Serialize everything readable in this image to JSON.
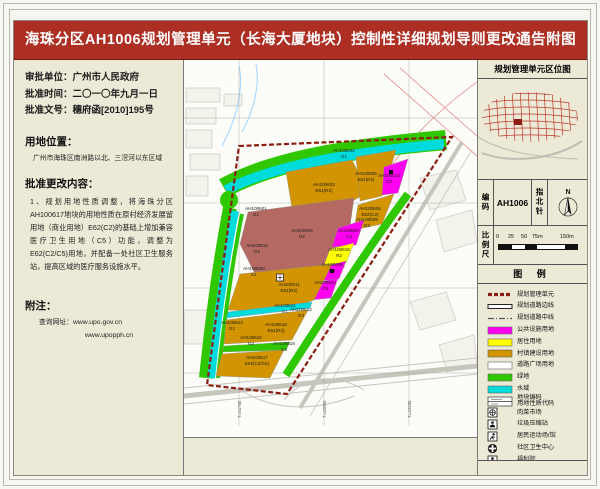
{
  "title": "海珠分区AH1006规划管理单元（长海大厦地块）控制性详细规划导则更改通告附图",
  "colors": {
    "title_bg": "#ad2f24",
    "panel_bg": "#ece9d6",
    "boundary_red": "#8b1d12",
    "public_facility": "#ff00f0",
    "residential": "#ffff00",
    "village_construction": "#d29400",
    "road_square": "#ffffff",
    "green_space": "#2fc800",
    "water": "#00dcdc",
    "existing_residential": "#b46a62"
  },
  "left_panel": {
    "info_lines": [
      {
        "label": "审批单位：",
        "value": "广州市人民政府"
      },
      {
        "label": "批准时间：",
        "value": "二〇一〇年九月一日"
      },
      {
        "label": "批准文号：",
        "value": "穗府函[2010]195号"
      }
    ],
    "location_header": "用地位置：",
    "location_text": "广州市海珠区南洲路以北、三滘河以东区域",
    "changes_header": "批准更改内容：",
    "changes_text": "1、规划用地性质调整，将海珠分区AH100617地块的用地性质在原村经济发展留用地（商业用地）E62(C2)的基础上增加兼容医疗卫生用地（C5）功能，调整为E62(C2/C5)用地，并配备一处社区卫生服务站，提高区域的医疗服务设施水平。",
    "notes_header": "附注：",
    "notes_label": "查询网址：",
    "urls": [
      "www.upo.gov.cn",
      "www.upopph.cn"
    ]
  },
  "right_panel": {
    "location_map_title": "规划管理单元区位图",
    "code_label": "编码",
    "code_value": "AH1006",
    "compass_label": "指北针",
    "compass_n": "N",
    "scale_label": "比例尺",
    "scale_ticks": [
      "0",
      "25",
      "50",
      "75m",
      "150m"
    ],
    "legend_title": "图 例",
    "legend_items": [
      {
        "label": "规划管理单元",
        "type": "boundary"
      },
      {
        "label": "规划道路边线",
        "type": "road-edge"
      },
      {
        "label": "规划道路中线",
        "type": "road-center"
      },
      {
        "label": "公共设施用地",
        "type": "fill",
        "color": "#ff00f0"
      },
      {
        "label": "居住用地",
        "type": "fill",
        "color": "#ffff00"
      },
      {
        "label": "村镇建设用地",
        "type": "fill",
        "color": "#d29400"
      },
      {
        "label": "道路广场用地",
        "type": "fill",
        "color": "#ffffff"
      },
      {
        "label": "绿地",
        "type": "fill",
        "color": "#2fc800"
      },
      {
        "label": "水域",
        "type": "fill",
        "color": "#00dcdc"
      },
      {
        "label": "地块编码\n用地性质代码",
        "type": "code-box"
      },
      {
        "label": "肉菜市场",
        "type": "icon-market"
      },
      {
        "label": "垃圾压缩站",
        "type": "icon-trash"
      },
      {
        "label": "居民运动场/馆",
        "type": "icon-sport"
      },
      {
        "label": "社区卫生中心",
        "type": "icon-health"
      },
      {
        "label": "福利院",
        "type": "icon-welfare"
      }
    ]
  },
  "map": {
    "parcels": [
      {
        "code": "AH100601",
        "cls": "G1",
        "x": 72,
        "y": 150
      },
      {
        "code": "AH100602",
        "cls": "G1",
        "x": 160,
        "y": 92
      },
      {
        "code": "AH100603",
        "cls": "E61(R2)",
        "x": 140,
        "y": 126
      },
      {
        "code": "AH100604",
        "cls": "R2",
        "x": 118,
        "y": 172
      },
      {
        "code": "AH100605",
        "cls": "E61(R2)",
        "x": 182,
        "y": 115
      },
      {
        "code": "AH100606",
        "cls": "E62(C2)",
        "x": 186,
        "y": 150
      },
      {
        "code": "AH100607",
        "cls": "C4",
        "x": 165,
        "y": 172
      },
      {
        "code": "AH100608",
        "cls": "C9",
        "x": 148,
        "y": 206
      },
      {
        "code": "AH100609",
        "cls": "G2",
        "x": 183,
        "y": 161
      },
      {
        "code": "AH100610",
        "cls": "C9",
        "x": 141,
        "y": 224
      },
      {
        "code": "AH100611",
        "cls": "E61(R2)",
        "x": 105,
        "y": 226
      },
      {
        "code": "AH100612",
        "cls": "G3",
        "x": 117,
        "y": 251
      },
      {
        "code": "AH100613",
        "cls": "G1",
        "x": 48,
        "y": 264
      },
      {
        "code": "AH100614",
        "cls": "C2",
        "x": 205,
        "y": 117
      },
      {
        "code": "AH100615",
        "cls": "G2",
        "x": 73,
        "y": 187
      },
      {
        "code": "AH100616",
        "cls": "R2",
        "x": 155,
        "y": 191
      },
      {
        "code": "AH100617",
        "cls": "E62(C2/C5)",
        "x": 73,
        "y": 299
      },
      {
        "code": "AH100618",
        "cls": "E61(R2)",
        "x": 92,
        "y": 266
      },
      {
        "code": "AH100619",
        "cls": "G2",
        "x": 100,
        "y": 285
      },
      {
        "code": "AH100620",
        "cls": "E1",
        "x": 70,
        "y": 210
      },
      {
        "code": "AH100621",
        "cls": "E1",
        "x": 101,
        "y": 247
      },
      {
        "code": "AH100622",
        "cls": "G2",
        "x": 67,
        "y": 279
      }
    ],
    "grid_labels": [
      {
        "text": "T=41750",
        "x": 55
      },
      {
        "text": "T=42000",
        "x": 140
      },
      {
        "text": "T=42250",
        "x": 225
      }
    ]
  }
}
